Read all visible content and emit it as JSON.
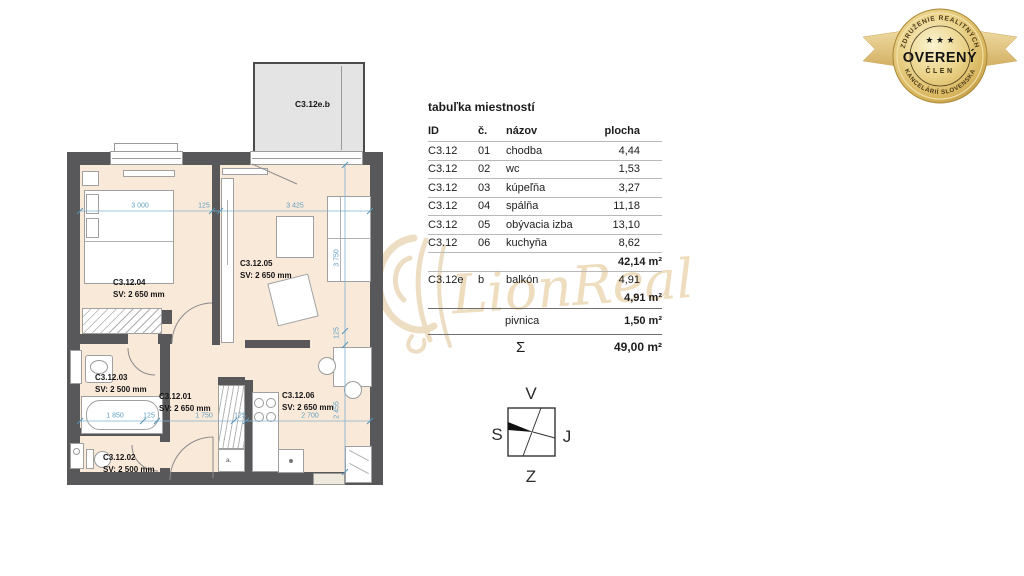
{
  "watermark": {
    "text": "LionReal"
  },
  "badge": {
    "arc_top": "ZDRUŽENIE REALITNÝCH",
    "arc_bottom": "KANCELÁRIÍ SLOVENSKA",
    "stars": "★ ★ ★",
    "title": "OVERENÝ",
    "subtitle": "ČLEN"
  },
  "plan": {
    "balcony_label": "C3.12e.b",
    "closet_label": "a.",
    "rooms": {
      "bedroom": {
        "id": "C3.12.04",
        "sv": "SV: 2 650 mm"
      },
      "living": {
        "id": "C3.12.05",
        "sv": "SV: 2 650 mm"
      },
      "bathroom": {
        "id": "C3.12.03",
        "sv": "SV: 2 500 mm"
      },
      "hall": {
        "id": "C3.12.01",
        "sv": "SV: 2 650 mm"
      },
      "wc": {
        "id": "C3.12.02",
        "sv": "SV: 2 500 mm"
      },
      "kitchen": {
        "id": "C3.12.06",
        "sv": "SV: 2 650 mm"
      }
    },
    "dims": {
      "top_1": "3 000",
      "top_2": "125",
      "top_3": "3 425",
      "right_1": "3 750",
      "right_2": "125",
      "right_3": "2 455",
      "bottom_1": "1 850",
      "bottom_2": "125",
      "bottom_3": "1 750",
      "bottom_4": "125",
      "bottom_5": "2 700"
    },
    "colors": {
      "wall": "#58585a",
      "floor": "#f9e9d9",
      "dim": "#5f9fc4",
      "balcony_fill": "#e4e4e4"
    }
  },
  "table": {
    "title": "tabuľka miestností",
    "headers": {
      "id": "ID",
      "no": "č.",
      "name": "názov",
      "area": "plocha"
    },
    "rows": [
      {
        "id": "C3.12",
        "no": "01",
        "name": "chodba",
        "area": "4,44"
      },
      {
        "id": "C3.12",
        "no": "02",
        "name": "wc",
        "area": "1,53"
      },
      {
        "id": "C3.12",
        "no": "03",
        "name": "kúpeľňa",
        "area": "3,27"
      },
      {
        "id": "C3.12",
        "no": "04",
        "name": "spálňa",
        "area": "11,18"
      },
      {
        "id": "C3.12",
        "no": "05",
        "name": "obývacia izba",
        "area": "13,10"
      },
      {
        "id": "C3.12",
        "no": "06",
        "name": "kuchyňa",
        "area": "8,62"
      }
    ],
    "subtotal_rooms": "42,14 m²",
    "balcony_row": {
      "id": "C3.12e",
      "no": "b",
      "name": "balkón",
      "area": "4,91"
    },
    "subtotal_balcony": "4,91 m²",
    "cellar_row": {
      "name": "pivnica",
      "area": "1,50 m²"
    },
    "total_row": {
      "symbol": "Σ",
      "area": "49,00 m²"
    }
  },
  "compass": {
    "top": "V",
    "right": "J",
    "bottom": "Z",
    "left": "S"
  }
}
